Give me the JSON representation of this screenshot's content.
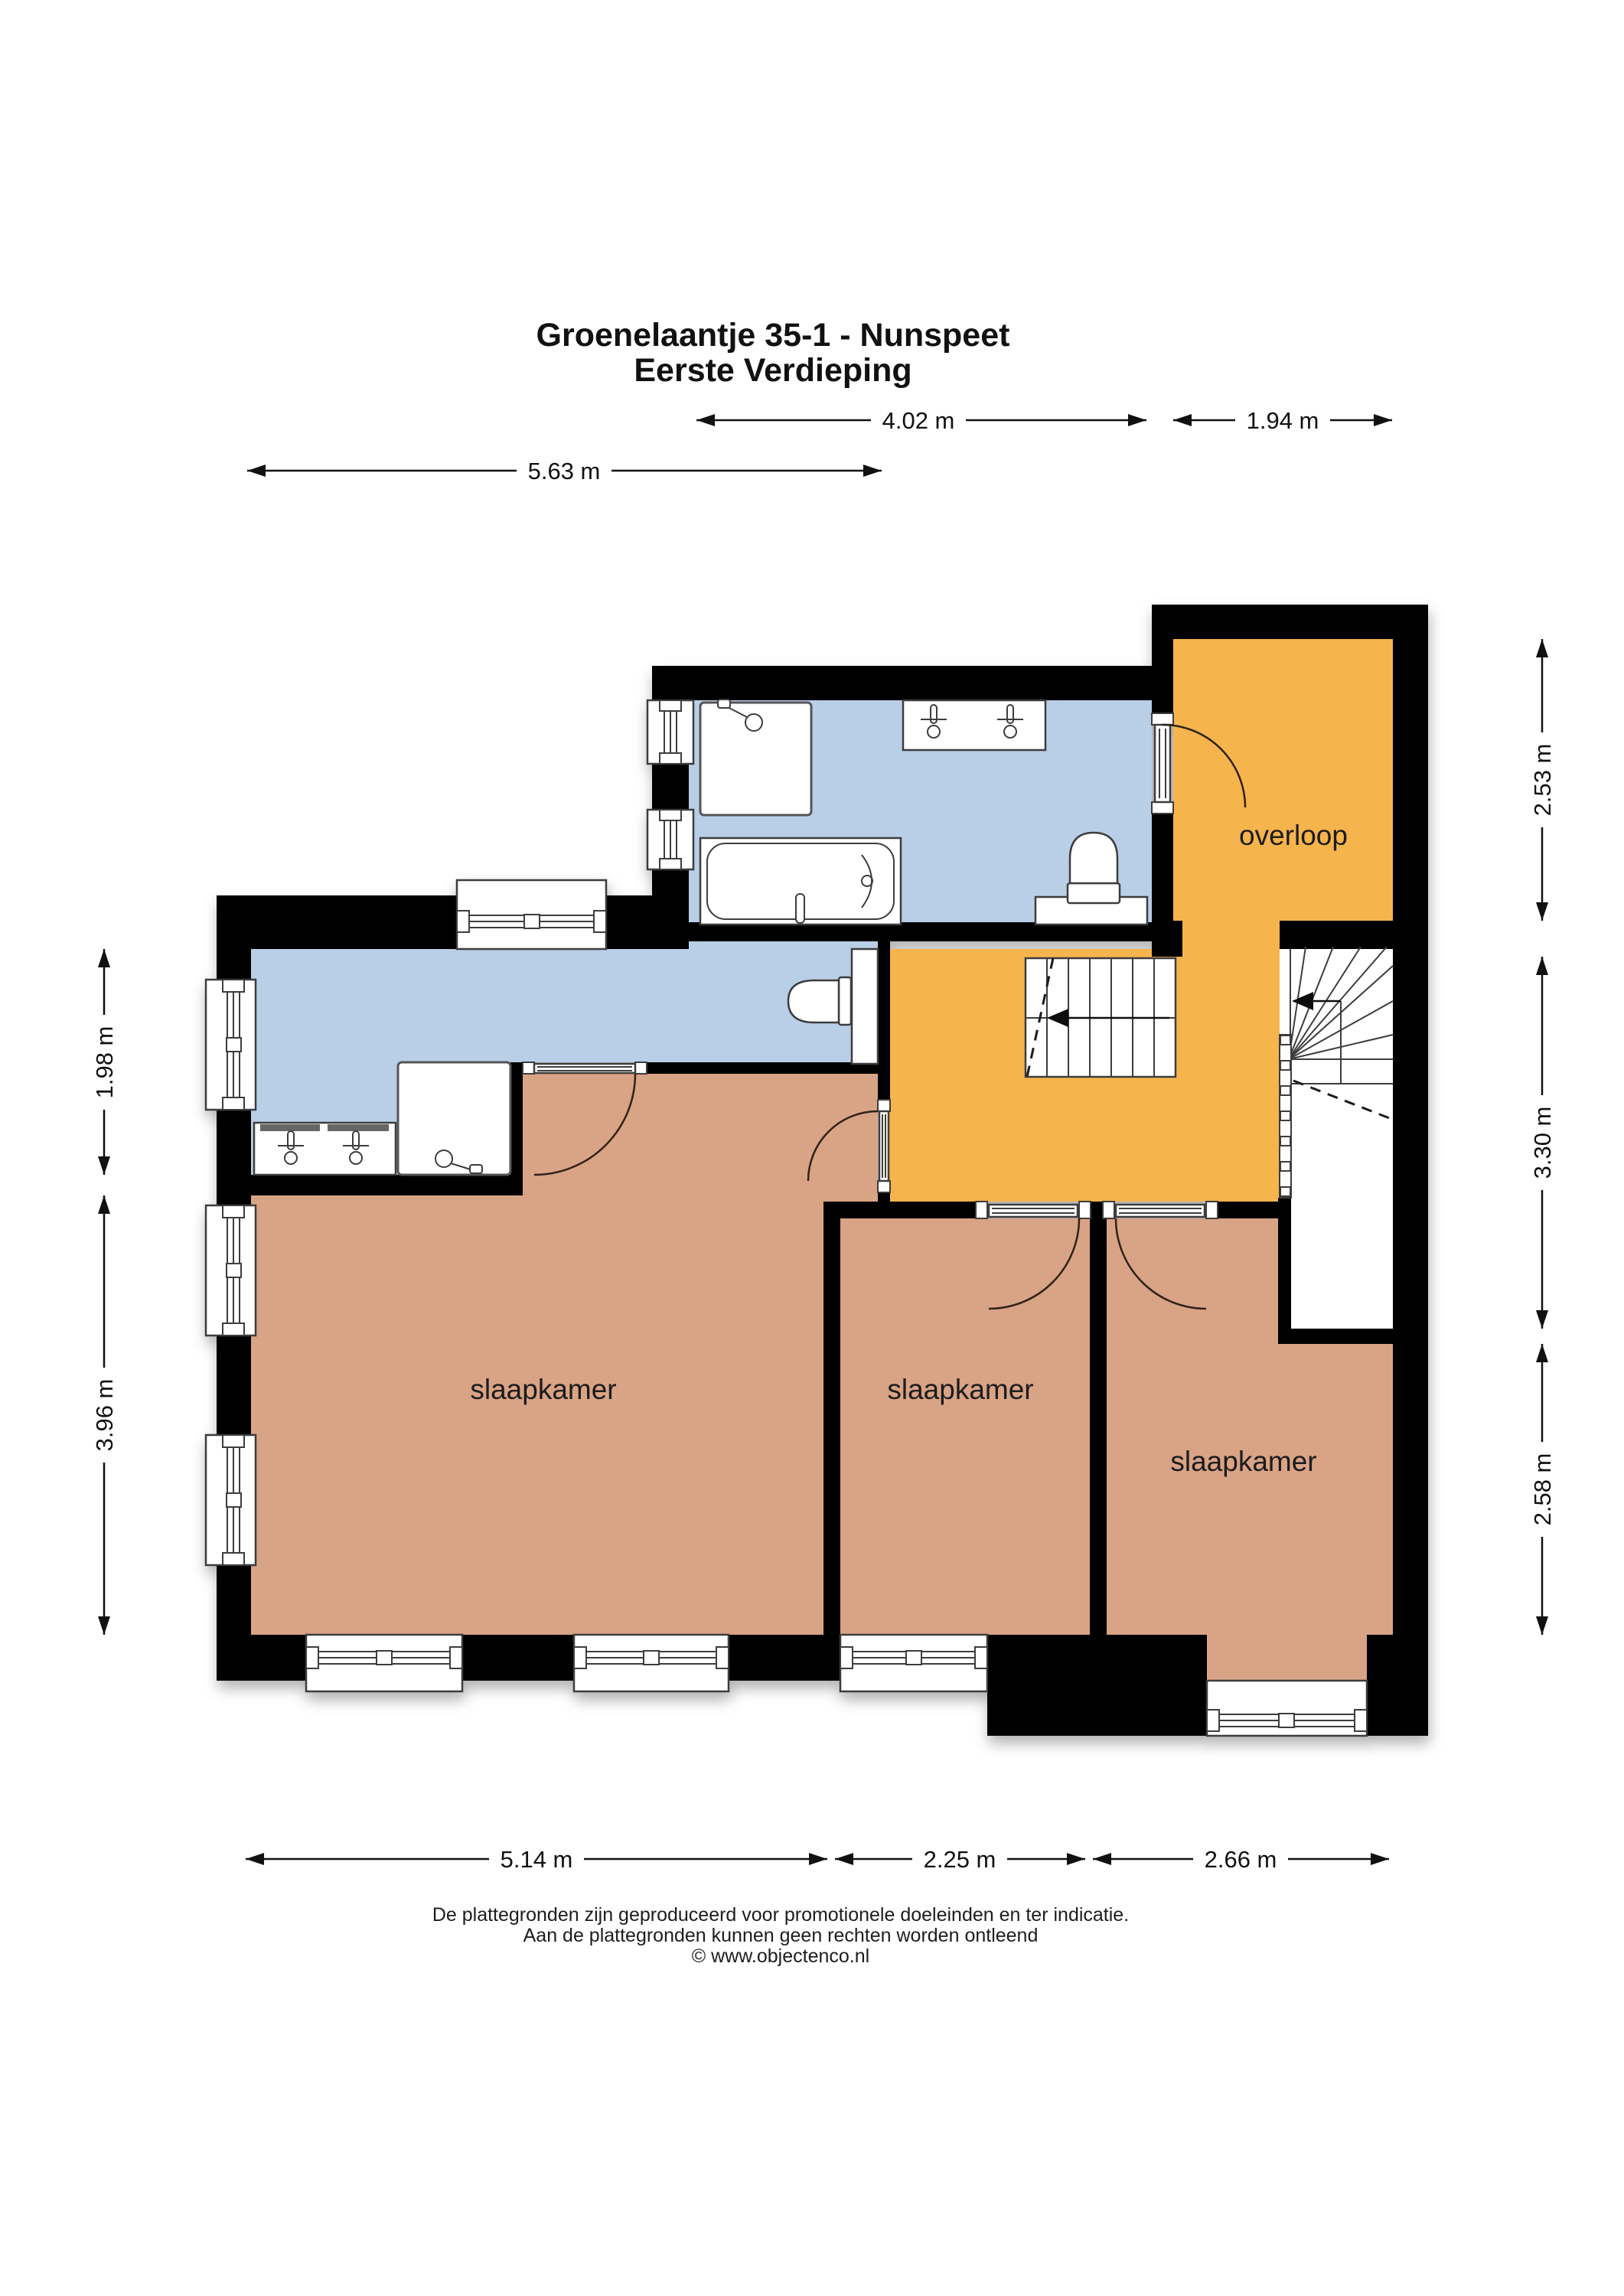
{
  "title": {
    "line1": "Groenelaantje 35-1 - Nunspeet",
    "line2": "Eerste Verdieping"
  },
  "rooms": [
    {
      "id": "overloop",
      "label": "overloop"
    },
    {
      "id": "slaapkamer-left",
      "label": "slaapkamer"
    },
    {
      "id": "slaapkamer-middle",
      "label": "slaapkamer"
    },
    {
      "id": "slaapkamer-right",
      "label": "slaapkamer"
    }
  ],
  "dimensions": {
    "top": [
      {
        "label": "4.02 m"
      },
      {
        "label": "1.94 m"
      }
    ],
    "top2": [
      {
        "label": "5.63 m"
      }
    ],
    "bottom": [
      {
        "label": "5.14 m"
      },
      {
        "label": "2.25 m"
      },
      {
        "label": "2.66 m"
      }
    ],
    "left": [
      {
        "label": "1.98 m"
      },
      {
        "label": "3.96 m"
      }
    ],
    "right": [
      {
        "label": "2.53 m"
      },
      {
        "label": "3.30 m"
      },
      {
        "label": "2.58 m"
      }
    ]
  },
  "footer": {
    "line1": "De plattegronden zijn geproduceerd voor promotionele doeleinden en ter indicatie.",
    "line2": "Aan de plattegronden kunnen geen rechten worden ontleend",
    "line3": "© www.objectenco.nl"
  },
  "colors": {
    "wall": "#000000",
    "wet_room_floor": "#B9CEE7",
    "circulation_floor": "#F6B44E",
    "bedroom_floor": "#D9A385",
    "outline": "#3C3C3C",
    "background": "#FFFFFF"
  },
  "icons": {
    "toilet": "toilet-icon",
    "bathtub": "bathtub-icon",
    "shower": "shower-icon",
    "faucet": "faucet-icon",
    "stairs": "stairs-icon",
    "door": "door-swing-icon",
    "window": "window-icon"
  }
}
